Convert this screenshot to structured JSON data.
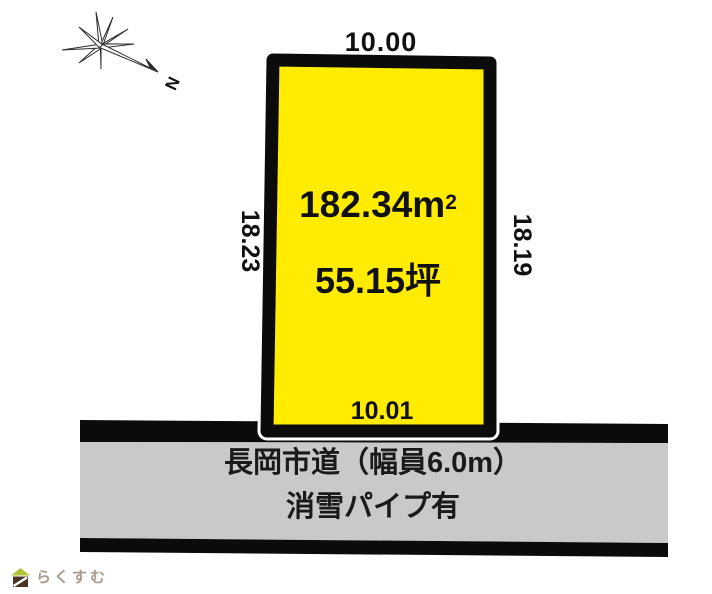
{
  "compass": {
    "north_label": "N"
  },
  "plot": {
    "fill_color": "#ffec00",
    "border_color": "#0b0b0b",
    "top_dim": "10.00",
    "left_dim": "18.23",
    "right_dim": "18.19",
    "bottom_dim": "10.01",
    "area_m2_value": "182.34m",
    "area_m2_sup": "2",
    "area_tsubo": "55.15坪"
  },
  "road": {
    "fill_color": "#c9c9c9",
    "border_color": "#0b0b0b",
    "line1": "長岡市道（幅員6.0m）",
    "line2": "消雪パイプ有"
  },
  "logo": {
    "text": "らくすむ",
    "roof_color": "#b0c43a",
    "body_color": "#4a3423"
  }
}
